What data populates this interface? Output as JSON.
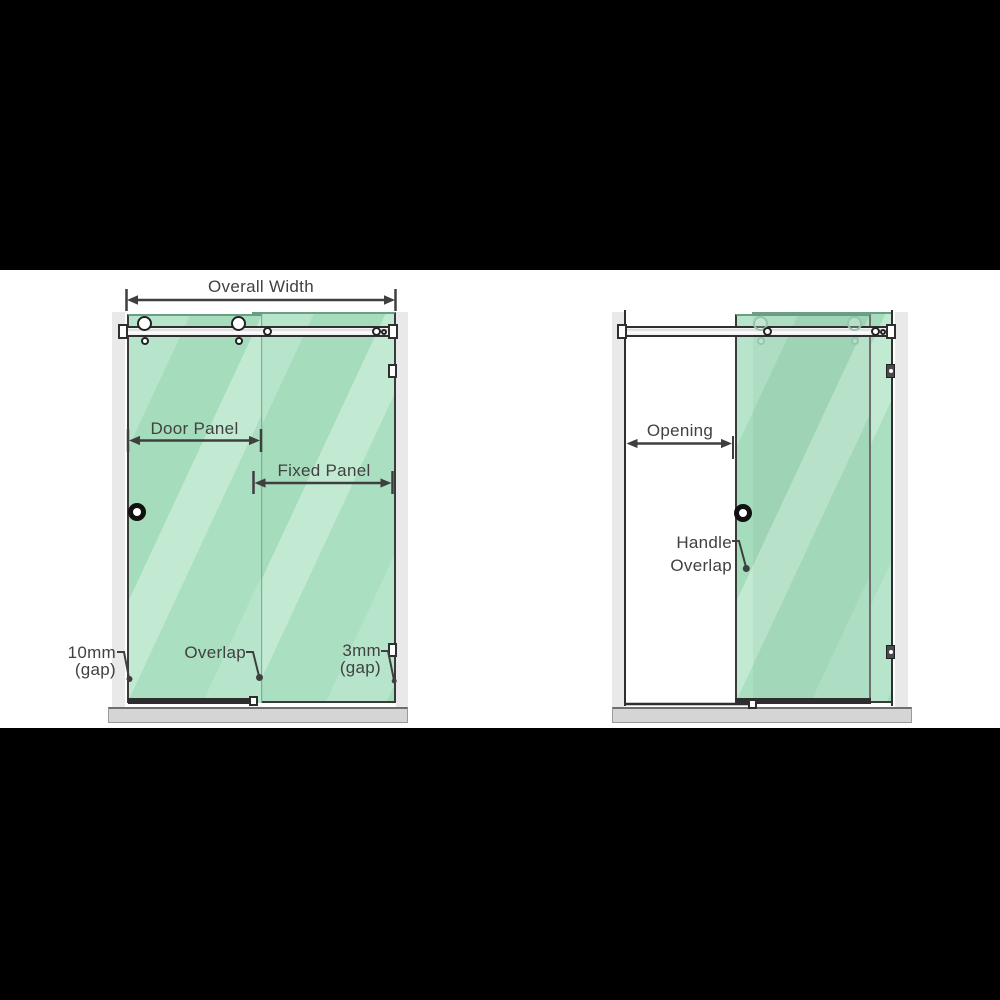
{
  "colors": {
    "glass_green": "#ade1c5",
    "glass_stripe_light": "#c2ead3",
    "glass_stripe_dark": "#a5dcbc",
    "wall_gray": "#e9e9e9",
    "tray_gray": "#d5d5d5",
    "outline_dark": "#2f2f2f",
    "label_gray": "#414141",
    "letterbox_black": "#000000"
  },
  "left": {
    "labels": {
      "overall_width": "Overall Width",
      "door_panel": "Door Panel",
      "fixed_panel": "Fixed Panel",
      "gap_left_value": "10mm",
      "gap_left_unit": "(gap)",
      "overlap": "Overlap",
      "gap_right_value": "3mm",
      "gap_right_unit": "(gap)"
    }
  },
  "right": {
    "labels": {
      "opening": "Opening",
      "handle_line1": "Handle",
      "handle_line2": "Overlap"
    }
  }
}
